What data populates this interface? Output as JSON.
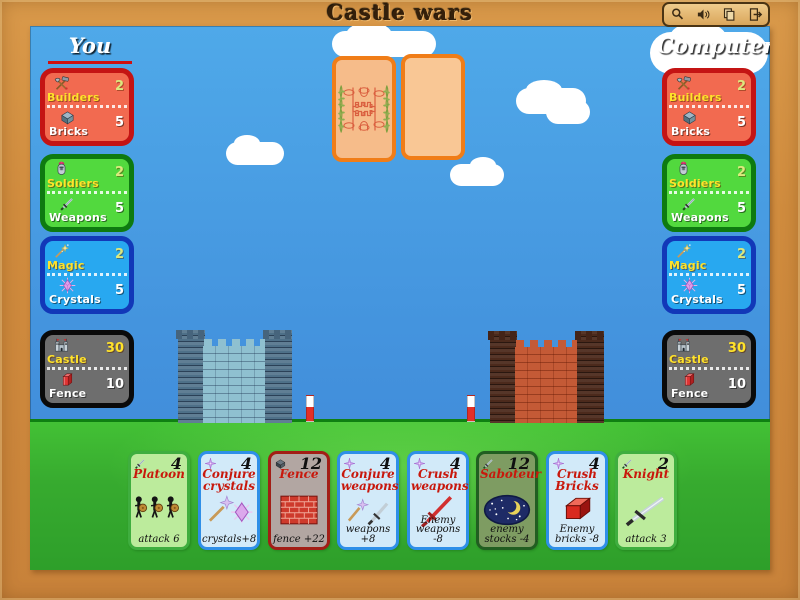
{
  "window": {
    "title": "Castle wars"
  },
  "toolbar": {
    "buttons": [
      "magnifier",
      "sound",
      "copy",
      "exit"
    ]
  },
  "turn": {
    "current_player": "You"
  },
  "players": {
    "you": {
      "label": "You",
      "resources": {
        "builders": {
          "label": "Builders",
          "value": "2"
        },
        "bricks": {
          "label": "Bricks",
          "value": "5"
        },
        "soldiers": {
          "label": "Soldiers",
          "value": "2"
        },
        "weapons": {
          "label": "Weapons",
          "value": "5"
        },
        "magic": {
          "label": "Magic",
          "value": "2"
        },
        "crystals": {
          "label": "Crystals",
          "value": "5"
        },
        "castle": {
          "label": "Castle",
          "value": "30"
        },
        "fence": {
          "label": "Fence",
          "value": "10"
        }
      }
    },
    "computer": {
      "label": "Computer",
      "resources": {
        "builders": {
          "label": "Builders",
          "value": "2"
        },
        "bricks": {
          "label": "Bricks",
          "value": "5"
        },
        "soldiers": {
          "label": "Soldiers",
          "value": "2"
        },
        "weapons": {
          "label": "Weapons",
          "value": "5"
        },
        "magic": {
          "label": "Magic",
          "value": "2"
        },
        "crystals": {
          "label": "Crystals",
          "value": "5"
        },
        "castle": {
          "label": "Castle",
          "value": "30"
        },
        "fence": {
          "label": "Fence",
          "value": "10"
        }
      }
    }
  },
  "center": {
    "draw_pile": "card-back",
    "discard_slot": "empty"
  },
  "hand": {
    "cards": [
      {
        "name": "Platoon",
        "cost": "4",
        "effect": "attack 6",
        "cost_icon": "sword-icon"
      },
      {
        "name": "Conjure crystals",
        "cost": "4",
        "effect": "crystals+8",
        "cost_icon": "sparkle-icon"
      },
      {
        "name": "Fence",
        "cost": "12",
        "effect": "fence +22",
        "cost_icon": "brick-icon"
      },
      {
        "name": "Conjure weapons",
        "cost": "4",
        "effect": "weapons +8",
        "cost_icon": "sparkle-icon"
      },
      {
        "name": "Crush weapons",
        "cost": "4",
        "effect": "Enemy weapons -8",
        "cost_icon": "sparkle-icon"
      },
      {
        "name": "Saboteur",
        "cost": "12",
        "effect": "enemy stocks -4",
        "cost_icon": "sword-icon"
      },
      {
        "name": "Crush Bricks",
        "cost": "4",
        "effect": "Enemy bricks -8",
        "cost_icon": "sparkle-icon"
      },
      {
        "name": "Knight",
        "cost": "2",
        "effect": "attack 3",
        "cost_icon": "sword-icon"
      }
    ]
  },
  "colors": {
    "frame": "#D08C3E",
    "sky": "#4FA9E9",
    "grass": "#37AB2F",
    "turn_underline": "#D01010",
    "panel_builders_bg": "#F26A50",
    "panel_builders_border": "#C41414",
    "panel_soldiers_bg": "#52D93E",
    "panel_soldiers_border": "#0E7A10",
    "panel_magic_bg": "#28A8F0",
    "panel_magic_border": "#1238B8",
    "panel_castle_bg": "#6E6E6E",
    "panel_castle_border": "#0A0A0A",
    "card_back_border": "#F07D18",
    "card_back_fill": "#F6BC8A",
    "castle_you_wall": "#8FC0D0",
    "castle_computer_wall": "#C45A36",
    "card_title": "#C8180C",
    "hand_green": "#BCEB9C",
    "hand_blue": "#D2EAF9",
    "hand_gray": "#B2A6A2",
    "hand_olive": "#7E9C62"
  }
}
